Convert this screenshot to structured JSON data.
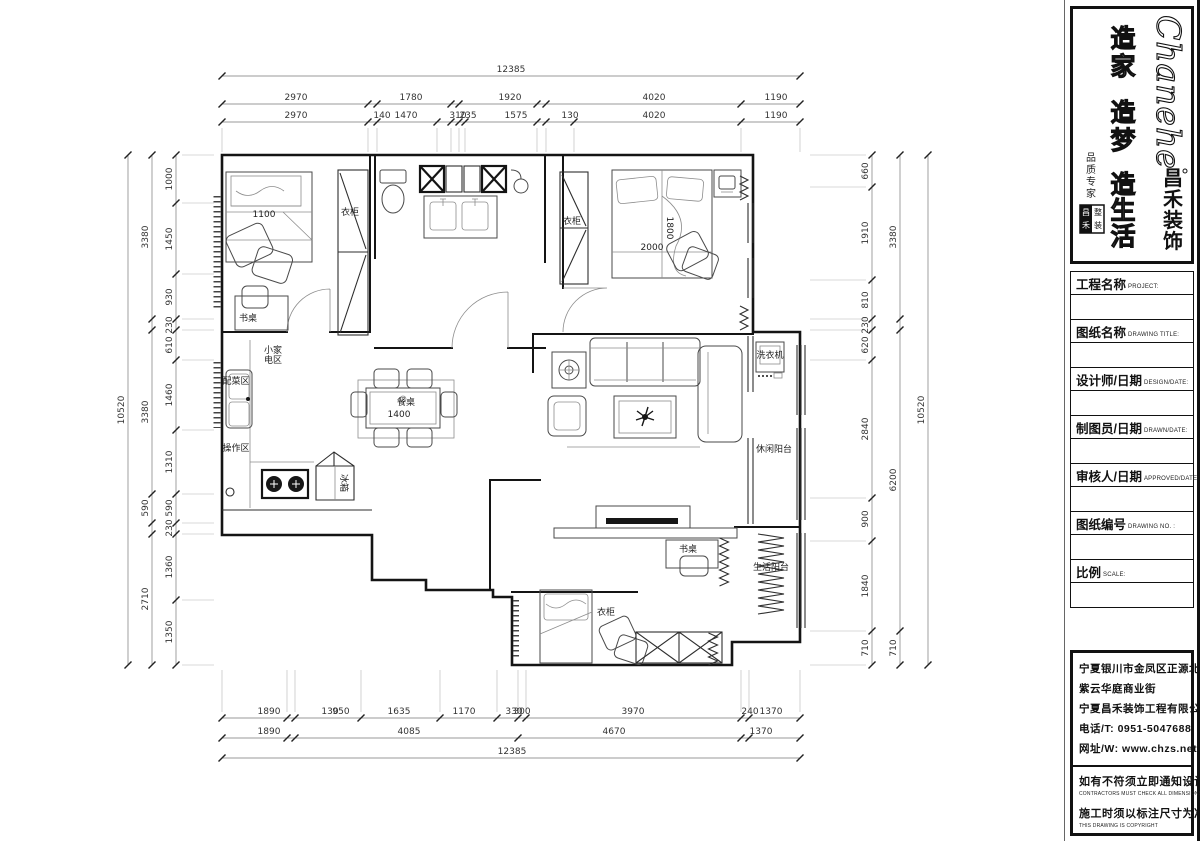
{
  "logo": {
    "brand_en": "Chanehe",
    "brand_cn_chars": [
      "昌",
      "禾",
      "装",
      "饰"
    ],
    "slogan": [
      [
        "造",
        "家"
      ],
      [
        "造",
        "梦"
      ],
      [
        "造",
        "生",
        "活"
      ]
    ],
    "signature_chars": [
      "品",
      "质",
      "专",
      "家"
    ],
    "seal_chars": [
      "昌",
      "禾",
      "整",
      "装"
    ]
  },
  "title_block": {
    "fields": [
      {
        "cn": "工程名称",
        "en": "PROJECT:"
      },
      {
        "cn": "图纸名称",
        "en": "DRAWING TITLE:"
      },
      {
        "cn": "设计师/日期",
        "en": "DESIGN/DATE:"
      },
      {
        "cn": "制图员/日期",
        "en": "DRAWN/DATE:"
      },
      {
        "cn": "审核人/日期",
        "en": "APPROVED/DATE:"
      },
      {
        "cn": "图纸编号",
        "en": "DRAWING NO. :"
      },
      {
        "cn": "比例",
        "en": "SCALE:"
      }
    ]
  },
  "company": {
    "address1": "宁夏银川市金凤区正源北街",
    "address2": "紫云华庭商业街",
    "name": "宁夏昌禾装饰工程有限公司",
    "phone": "电话/T: 0951-5047688",
    "website": "网址/W: www.chzs.net",
    "notice1_cn": "如有不符须立即通知设计人员",
    "notice1_en": "CONTRACTORS MUST CHECK ALL DIMENSIONS ON SITE",
    "notice2_cn": "施工时须以标注尺寸为准",
    "notice2_en": "THIS DRAWING IS COPYRIGHT"
  },
  "plan": {
    "dim_chains": [
      {
        "o": "h",
        "pos": 76,
        "a": 222,
        "b": 800,
        "ticks": [
          222,
          800
        ],
        "labels": [
          {
            "t": "12385",
            "p": 511
          }
        ]
      },
      {
        "o": "h",
        "pos": 104,
        "a": 222,
        "b": 800,
        "ticks": [
          222,
          368,
          377,
          451,
          459,
          537,
          546,
          741,
          800
        ],
        "labels": [
          {
            "t": "2970",
            "p": 296
          },
          {
            "t": "1780",
            "p": 411
          },
          {
            "t": "1920",
            "p": 510
          },
          {
            "t": "4020",
            "p": 654
          },
          {
            "t": "1190",
            "p": 776
          }
        ]
      },
      {
        "o": "h",
        "pos": 122,
        "a": 222,
        "b": 800,
        "ticks": [
          222,
          368,
          377,
          437,
          451,
          459,
          465,
          537,
          546,
          574,
          741,
          800
        ],
        "labels": [
          {
            "t": "2970",
            "p": 296
          },
          {
            "t": "140",
            "p": 382
          },
          {
            "t": "1470",
            "p": 406
          },
          {
            "t": "310",
            "p": 458
          },
          {
            "t": "235",
            "p": 468
          },
          {
            "t": "1575",
            "p": 516
          },
          {
            "t": "130",
            "p": 570
          },
          {
            "t": "4020",
            "p": 654
          },
          {
            "t": "1190",
            "p": 776
          }
        ],
        "ext": [
          128,
          152
        ]
      },
      {
        "o": "h",
        "pos": 718,
        "a": 222,
        "b": 800,
        "ticks": [
          222,
          287,
          295,
          361,
          440,
          497,
          518,
          526,
          741,
          749,
          800
        ],
        "labels": [
          {
            "t": "1890",
            "p": 269
          },
          {
            "t": "130",
            "p": 330
          },
          {
            "t": "950",
            "p": 341
          },
          {
            "t": "1635",
            "p": 399
          },
          {
            "t": "1170",
            "p": 464
          },
          {
            "t": "330",
            "p": 514
          },
          {
            "t": "300",
            "p": 522
          },
          {
            "t": "3970",
            "p": 633
          },
          {
            "t": "240",
            "p": 750
          },
          {
            "t": "1370",
            "p": 771
          }
        ],
        "ext": [
          670,
          712
        ]
      },
      {
        "o": "h",
        "pos": 738,
        "a": 222,
        "b": 800,
        "ticks": [
          222,
          287,
          295,
          518,
          741,
          749,
          800
        ],
        "labels": [
          {
            "t": "1890",
            "p": 269
          },
          {
            "t": "4085",
            "p": 409
          },
          {
            "t": "4670",
            "p": 614
          },
          {
            "t": "1370",
            "p": 761
          }
        ]
      },
      {
        "o": "h",
        "pos": 758,
        "a": 222,
        "b": 800,
        "ticks": [
          222,
          800
        ],
        "labels": [
          {
            "t": "12385",
            "p": 512
          }
        ]
      },
      {
        "o": "v",
        "pos": 128,
        "a": 155,
        "b": 665,
        "ticks": [
          155,
          665
        ],
        "labels": [
          {
            "t": "10520",
            "p": 410
          }
        ]
      },
      {
        "o": "v",
        "pos": 152,
        "a": 155,
        "b": 665,
        "ticks": [
          155,
          319,
          330,
          494,
          523,
          534,
          665
        ],
        "labels": [
          {
            "t": "3380",
            "p": 237
          },
          {
            "t": "3380",
            "p": 412
          },
          {
            "t": "590",
            "p": 508
          },
          {
            "t": "2710",
            "p": 599
          }
        ]
      },
      {
        "o": "v",
        "pos": 176,
        "a": 155,
        "b": 665,
        "ticks": [
          155,
          203,
          274,
          319,
          330,
          360,
          430,
          494,
          523,
          534,
          600,
          665
        ],
        "labels": [
          {
            "t": "1000",
            "p": 179
          },
          {
            "t": "1450",
            "p": 239
          },
          {
            "t": "930",
            "p": 297
          },
          {
            "t": "230",
            "p": 325
          },
          {
            "t": "610",
            "p": 345
          },
          {
            "t": "1460",
            "p": 395
          },
          {
            "t": "1310",
            "p": 462
          },
          {
            "t": "590",
            "p": 508
          },
          {
            "t": "230",
            "p": 528
          },
          {
            "t": "1360",
            "p": 567
          },
          {
            "t": "1350",
            "p": 632
          }
        ],
        "ext": [
          182,
          214
        ]
      },
      {
        "o": "v",
        "pos": 872,
        "a": 155,
        "b": 665,
        "ticks": [
          155,
          187,
          280,
          319,
          330,
          360,
          498,
          541,
          631,
          665
        ],
        "labels": [
          {
            "t": "660",
            "p": 171
          },
          {
            "t": "1910",
            "p": 233
          },
          {
            "t": "810",
            "p": 300
          },
          {
            "t": "230",
            "p": 325
          },
          {
            "t": "620",
            "p": 345
          },
          {
            "t": "2840",
            "p": 429
          },
          {
            "t": "900",
            "p": 519
          },
          {
            "t": "1840",
            "p": 586
          },
          {
            "t": "710",
            "p": 648
          }
        ],
        "ext": [
          810,
          866
        ]
      },
      {
        "o": "v",
        "pos": 900,
        "a": 155,
        "b": 665,
        "ticks": [
          155,
          319,
          330,
          631,
          665
        ],
        "labels": [
          {
            "t": "3380",
            "p": 237
          },
          {
            "t": "6200",
            "p": 480
          },
          {
            "t": "710",
            "p": 648
          }
        ]
      },
      {
        "o": "v",
        "pos": 928,
        "a": 155,
        "b": 665,
        "ticks": [
          155,
          665
        ],
        "labels": [
          {
            "t": "10520",
            "p": 410
          }
        ]
      }
    ],
    "room_labels": [
      {
        "t": "衣柜",
        "x": 350,
        "y": 215,
        "s": 8
      },
      {
        "t": "书桌",
        "x": 248,
        "y": 321,
        "s": 9
      },
      {
        "t": "1100",
        "x": 264,
        "y": 217,
        "s": 6,
        "c": "#999"
      },
      {
        "t": "衣柜",
        "x": 572,
        "y": 224,
        "s": 8
      },
      {
        "t": "小家",
        "x": 273,
        "y": 353,
        "s": 8
      },
      {
        "t": "电区",
        "x": 273,
        "y": 363,
        "s": 8
      },
      {
        "t": "配菜区",
        "x": 236,
        "y": 384,
        "s": 8
      },
      {
        "t": "操作区",
        "x": 236,
        "y": 451,
        "s": 8
      },
      {
        "t": "餐桌",
        "x": 406,
        "y": 405,
        "s": 9
      },
      {
        "t": "1400",
        "x": 399,
        "y": 417,
        "s": 7,
        "c": "#999"
      },
      {
        "t": "冰箱",
        "x": 341,
        "y": 483,
        "s": 7,
        "r": 90
      },
      {
        "t": "洗衣机",
        "x": 770,
        "y": 358,
        "s": 6
      },
      {
        "t": "休闲阳台",
        "x": 774,
        "y": 452,
        "s": 9
      },
      {
        "t": "书桌",
        "x": 688,
        "y": 552,
        "s": 9
      },
      {
        "t": "生活阳台",
        "x": 771,
        "y": 570,
        "s": 9
      },
      {
        "t": "衣柜",
        "x": 606,
        "y": 615,
        "s": 8
      },
      {
        "t": "2000",
        "x": 652,
        "y": 250,
        "s": 6,
        "c": "#999"
      },
      {
        "t": "1800",
        "x": 667,
        "y": 228,
        "s": 6,
        "c": "#999",
        "r": 90
      }
    ]
  }
}
